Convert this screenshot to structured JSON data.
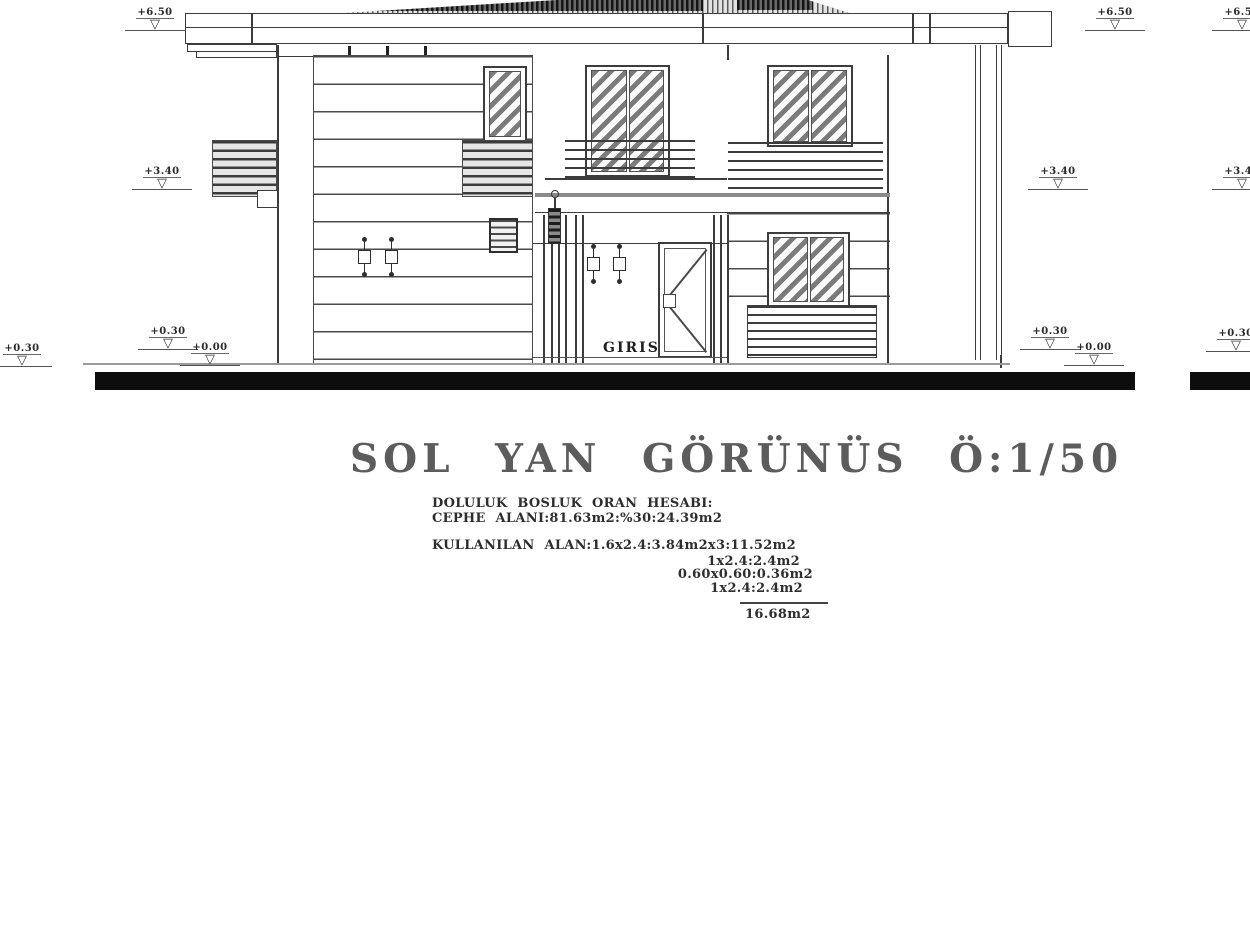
{
  "title_block": {
    "title": "SOL YAN GÖRÜNÜS Ö:1/50"
  },
  "calc_block": {
    "heading": "DOLULUK BOSLUK ORAN HESABI:",
    "facade_area": "CEPHE ALANI:81.63m2:%30:24.39m2",
    "used_area": "KULLANILAN ALAN:1.6x2.4:3.84m2x3:11.52m2",
    "item1": "1x2.4:2.4m2",
    "item2": "0.60x0.60:0.36m2",
    "item3": "1x2.4:2.4m2",
    "total": "16.68m2"
  },
  "elevation": {
    "entrance_label": "GIRIS",
    "levels": {
      "roof": "+6.50",
      "first_floor": "+3.40",
      "plinth": "+0.30",
      "ground": "+0.00"
    }
  },
  "colors": {
    "line": "#3c3c3c",
    "ground_bar": "#0d0d0d",
    "paper": "#ffffff"
  }
}
